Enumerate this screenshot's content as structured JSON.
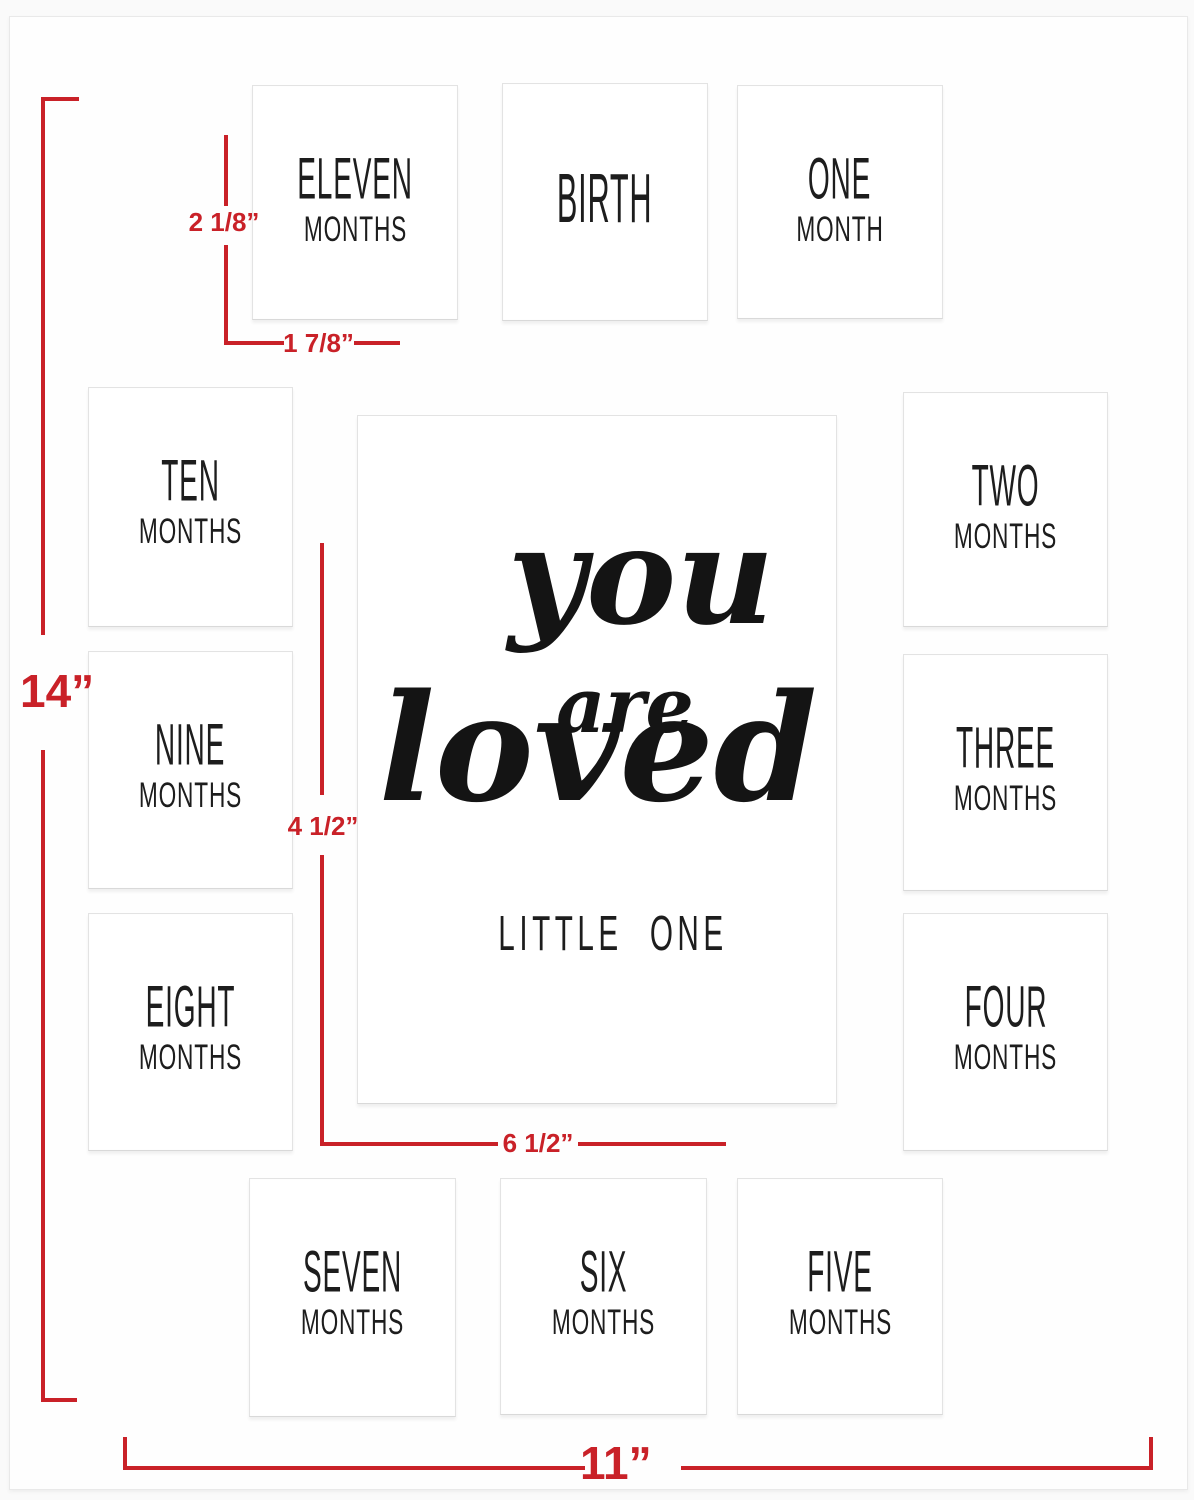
{
  "product": {
    "description": "Baby first-year milestone picture frame mat diagram with dimension callouts"
  },
  "openings": [
    {
      "id": "birth",
      "line1": "BIRTH",
      "line2": ""
    },
    {
      "id": "one",
      "line1": "ONE",
      "line2": "MONTH"
    },
    {
      "id": "two",
      "line1": "TWO",
      "line2": "MONTHS"
    },
    {
      "id": "three",
      "line1": "THREE",
      "line2": "MONTHS"
    },
    {
      "id": "four",
      "line1": "FOUR",
      "line2": "MONTHS"
    },
    {
      "id": "five",
      "line1": "FIVE",
      "line2": "MONTHS"
    },
    {
      "id": "six",
      "line1": "SIX",
      "line2": "MONTHS"
    },
    {
      "id": "seven",
      "line1": "SEVEN",
      "line2": "MONTHS"
    },
    {
      "id": "eight",
      "line1": "EIGHT",
      "line2": "MONTHS"
    },
    {
      "id": "nine",
      "line1": "NINE",
      "line2": "MONTHS"
    },
    {
      "id": "ten",
      "line1": "TEN",
      "line2": "MONTHS"
    },
    {
      "id": "eleven",
      "line1": "ELEVEN",
      "line2": "MONTHS"
    }
  ],
  "center_art": {
    "word1": "you",
    "word2": "are",
    "word3": "loved",
    "subtitle": "LITTLE ONE"
  },
  "dimensions": {
    "mat_height_label": "14”",
    "mat_width_label": "11”",
    "opening_height_label": "2 1/8”",
    "opening_width_label": "1 7/8”",
    "center_vertical_label": "4 1/2”",
    "center_horizontal_label": "6 1/2”"
  },
  "colors": {
    "dimension_red": "#c92128",
    "text_black": "#1d1d1d",
    "mat_white": "#fefefe"
  }
}
